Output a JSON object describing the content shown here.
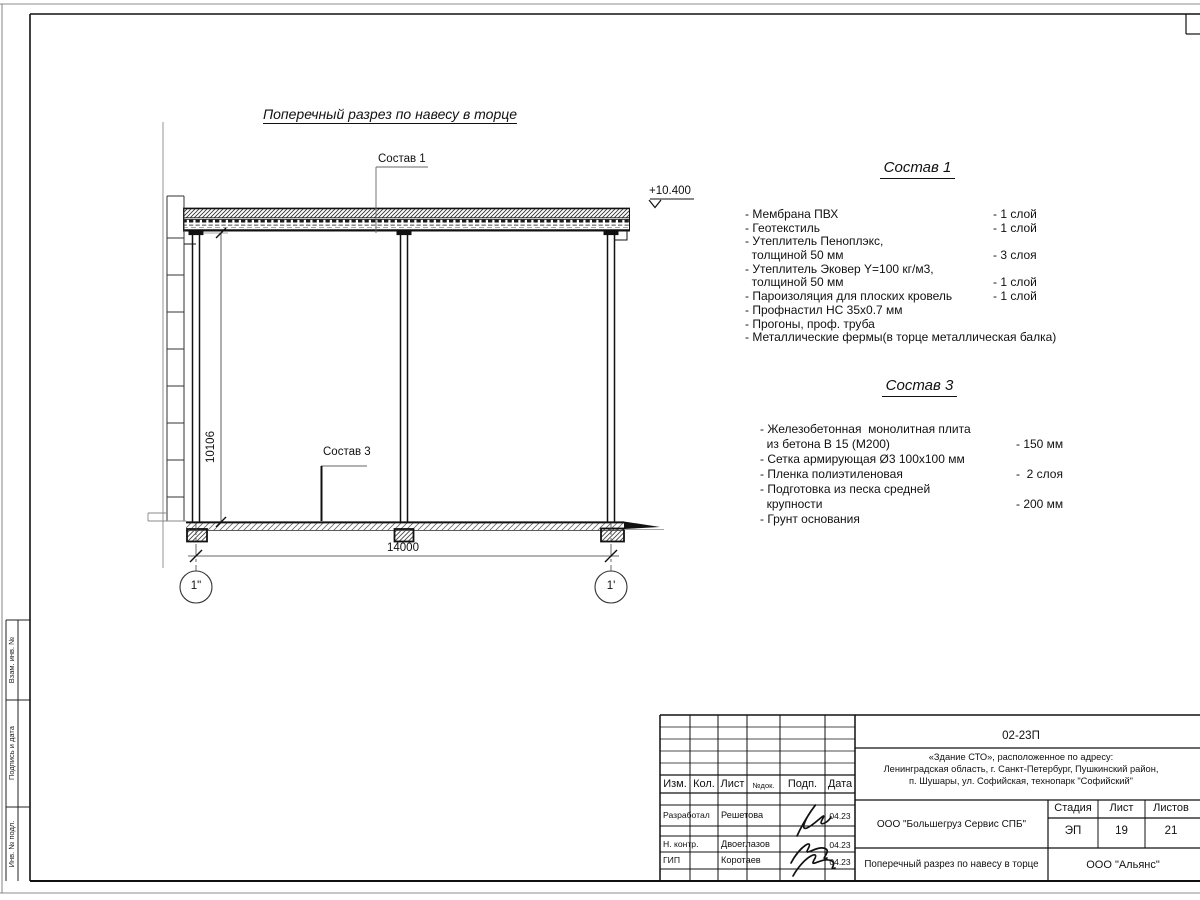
{
  "colors": {
    "paper": "#ffffff",
    "ink": "#111111",
    "thin_line": "#777777"
  },
  "frame": {
    "side_labels": {
      "vzam": "Взам. инв. №",
      "podpis": "Подпись и дата",
      "inv": "Инв. № подл."
    }
  },
  "drawing": {
    "title": "Поперечный разрез по навесу в торце",
    "callout1": "Состав 1",
    "callout3": "Состав 3",
    "level_mark": "+10.400",
    "dim_width": "14000",
    "dim_height": "10106",
    "axis_left": "1\"",
    "axis_right": "1'"
  },
  "spec1": {
    "title": "Состав 1",
    "items": [
      {
        "name": "- Мембрана ПВХ",
        "qty": "- 1 слой"
      },
      {
        "name": "- Геотекстиль",
        "qty": "- 1 слой"
      },
      {
        "name": "- Утеплитель Пеноплэкс,",
        "qty": ""
      },
      {
        "name": "  толщиной 50 мм",
        "qty": "- 3 слоя"
      },
      {
        "name": "- Утеплитель Эковер Y=100 кг/м3,",
        "qty": ""
      },
      {
        "name": "  толщиной 50 мм",
        "qty": "- 1 слой"
      },
      {
        "name": "- Пароизоляция для плоских кровель",
        "qty": "- 1 слой"
      },
      {
        "name": "- Профнастил НС 35x0.7 мм",
        "qty": ""
      },
      {
        "name": "- Прогоны, проф. труба",
        "qty": ""
      },
      {
        "name": "- Металлические фермы(в торце металлическая балка)",
        "qty": ""
      }
    ]
  },
  "spec3": {
    "title": "Состав 3",
    "items": [
      {
        "name": "- Железобетонная  монолитная плита",
        "qty": ""
      },
      {
        "name": "  из бетона В 15 (М200)",
        "qty": "- 150 мм"
      },
      {
        "name": "- Сетка армирующая Ø3 100x100 мм",
        "qty": ""
      },
      {
        "name": "- Пленка полиэтиленовая",
        "qty": "-  2 слоя"
      },
      {
        "name": "- Подготовка из песка средней",
        "qty": ""
      },
      {
        "name": "  крупности",
        "qty": "- 200 мм"
      },
      {
        "name": "- Грунт основания",
        "qty": ""
      }
    ]
  },
  "titleblock": {
    "doc_number": "02-23П",
    "object_line1": "«Здание СТО», расположенное по адресу:",
    "object_line2": "Ленинградская область, г. Санкт-Петербург, Пушкинский район,",
    "object_line3": "п. Шушары, ул. Софийская, технопарк \"Софийский\"",
    "col_izm": "Изм.",
    "col_kol": "Кол.",
    "col_list": "Лист",
    "col_doc": "№док.",
    "col_podp": "Подп.",
    "col_data": "Дата",
    "row1_role": "Разработал",
    "row1_name": "Решетова",
    "row1_date": "04.23",
    "row2_role": "Н. контр.",
    "row2_name": "Двоеглазов",
    "row2_date": "04.23",
    "row3_role": "ГИП",
    "row3_name": "Коротаев",
    "row3_date": "04.23",
    "company": "ООО \"Большегруз Сервис СПБ\"",
    "sheet_title": "Поперечный разрез по навесу в торце",
    "stage_label": "Стадия",
    "sheet_label": "Лист",
    "sheets_label": "Листов",
    "stage": "ЭП",
    "sheet": "19",
    "sheets": "21",
    "org": "ООО \"Альянс\""
  }
}
